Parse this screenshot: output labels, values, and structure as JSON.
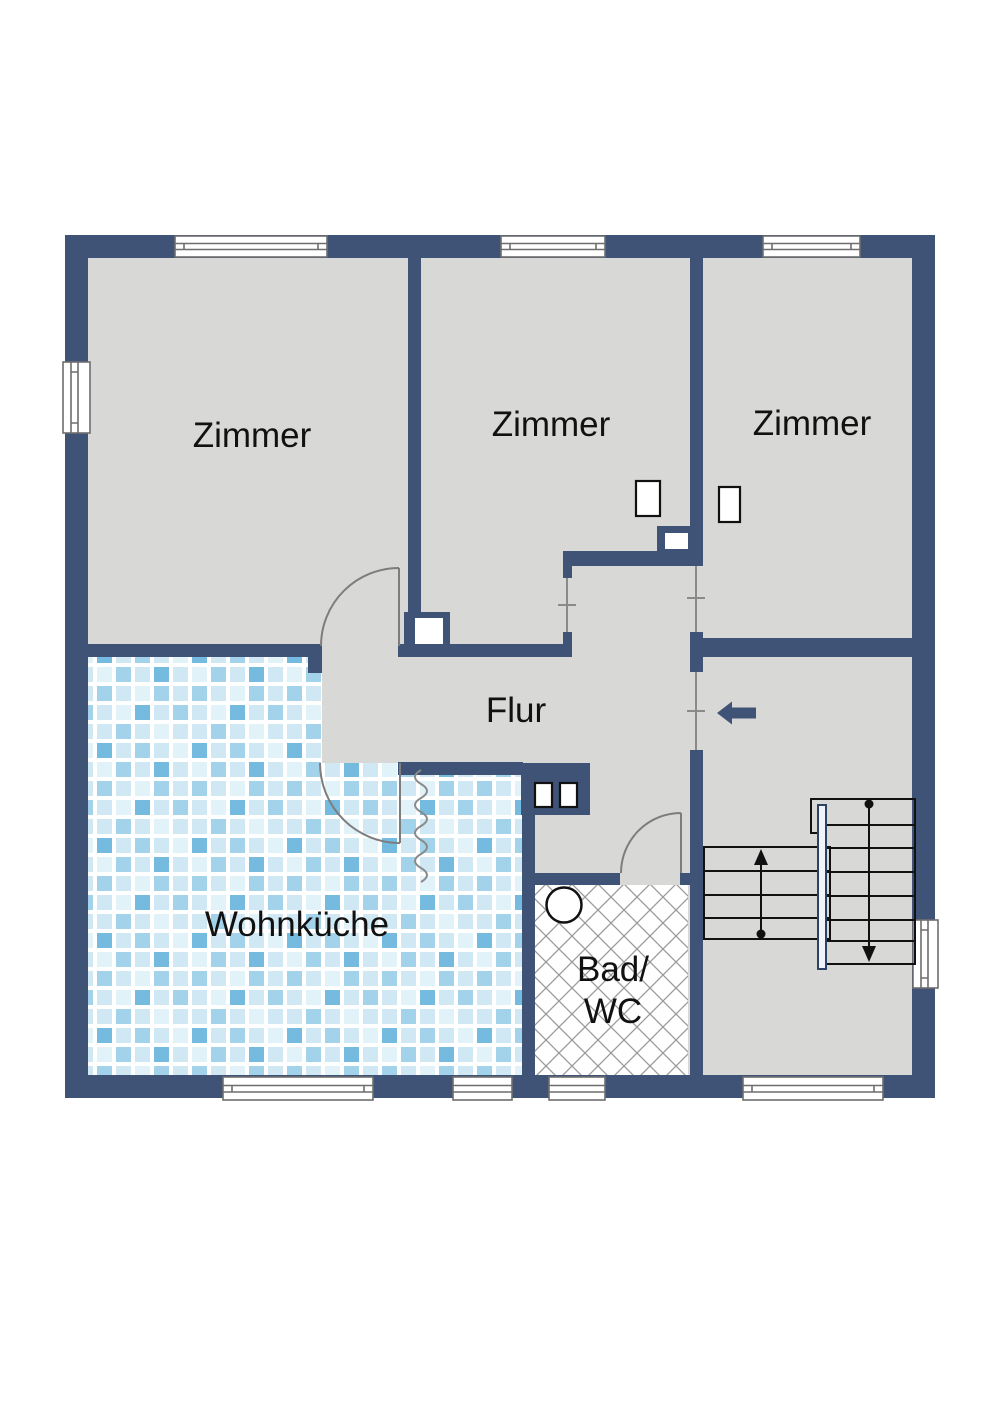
{
  "title": "Wohnung Grundriss",
  "colors": {
    "wall": "#3f5376",
    "floor": "#d8d8d6",
    "tile_light": "#cfe8f4",
    "tile_lighter": "#e2f2f9",
    "tile_medium": "#a3d3eb",
    "tile_dark": "#74bbdf",
    "hatch_line": "#9a9a9a",
    "window_stroke": "#6e6e6e",
    "door": "#7d7d7d",
    "stair_stroke": "#111111",
    "railing_fill": "#eef4fa",
    "railing_stroke": "#2e4264",
    "arrow": "#3f5376"
  },
  "rooms": [
    {
      "id": "zimmer-top-left",
      "label": "Zimmer"
    },
    {
      "id": "zimmer-top-middle",
      "label": "Zimmer"
    },
    {
      "id": "zimmer-top-right",
      "label": "Zimmer"
    },
    {
      "id": "flur",
      "label": "Flur"
    },
    {
      "id": "wohnkueche",
      "label": "Wohnküche"
    },
    {
      "id": "bad-wc",
      "label_line1": "Bad/",
      "label_line2": "WC"
    }
  ],
  "features": {
    "windows": 9,
    "door_arcs": 3,
    "open_doorways": 3,
    "entrance_arrow_direction": "left",
    "stair_flights": 2,
    "stair_up_arrow": "up",
    "stair_down_arrow": "down",
    "washbasin": 1,
    "radiators": 4,
    "chimney_shafts": 2
  }
}
